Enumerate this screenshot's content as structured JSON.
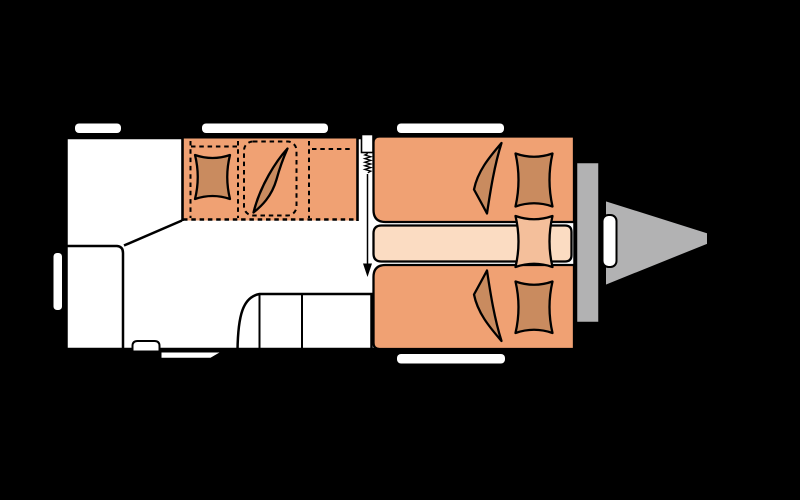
{
  "scene": {
    "kind": "caravan-floorplan-top-view",
    "orientation": "hitch-on-right"
  },
  "colors": {
    "background": "#000000",
    "body_fill": "#ffffff",
    "outline": "#000000",
    "upholstery": "#f0a173",
    "cushion_dark": "#c98b5f",
    "cushion_medium": "#f4bf9b",
    "mattress_light": "#fbdcc2",
    "metal_gray": "#b2b2b3",
    "window_white": "#ffffff"
  },
  "elements": {
    "body": "caravan-body",
    "windows": [
      "window-top-rear",
      "window-top-middle",
      "window-top-front",
      "window-bottom-front",
      "window-side-rear"
    ],
    "door": [
      "entrance-door",
      "door-spring",
      "door-swing-arrow"
    ],
    "furniture": [
      "dinette-bed",
      "dinette-pillow",
      "dinette-duvet",
      "dinette-mattress-outline",
      "wardrobe",
      "kitchen-unit",
      "heater",
      "single-bed-top",
      "single-bed-bottom",
      "center-mattress",
      "pillow-top",
      "pillow-center",
      "pillow-bottom",
      "duvet-top",
      "duvet-bottom"
    ],
    "exterior": [
      "service-step",
      "gas-locker",
      "drawbar",
      "coupling-handle"
    ]
  }
}
